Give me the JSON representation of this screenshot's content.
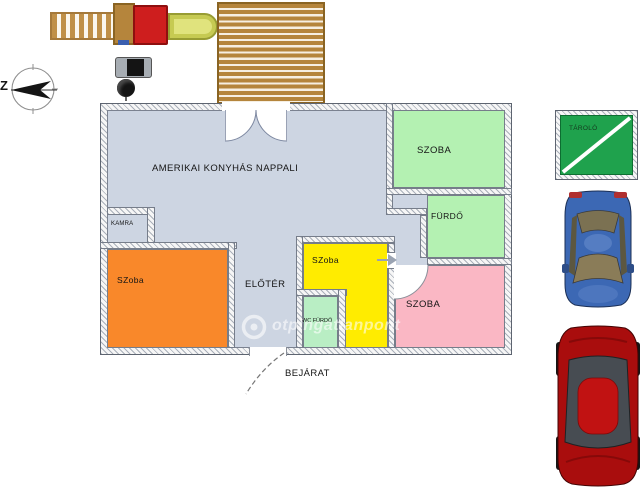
{
  "compass": {
    "label": "Z"
  },
  "floorplan": {
    "rooms": {
      "nappali": "AMERIKAI KONYHÁS NAPPALI",
      "kamra": "KAMRA",
      "szoba_orange": "SZoba",
      "eloter": "ELŐTÉR",
      "szoba_yellow": "SZoba",
      "wc_furdo": "WC FÜRDŐ",
      "szoba_pink": "SZOBA",
      "szoba_green": "SZOBA",
      "furdo": "FÜRDŐ"
    },
    "entrance_label": "BEJÁRAT",
    "colors": {
      "floor": "#cdd5e2",
      "room_green": "#b4f1b2",
      "wc_green": "#b9eec4",
      "room_orange": "#f9882a",
      "room_yellow": "#ffec00",
      "room_pink": "#fab7c4"
    }
  },
  "storage_sign": {
    "label": "TÁROLÓ",
    "color": "#1fa24d"
  },
  "watermark": {
    "text": "otpingatlanpont"
  },
  "objects": {
    "deck": "wooden-deck",
    "ladder": "playground-ladder",
    "tower": "playground-tower",
    "slide": "playground-slide",
    "grill": "grill",
    "car_blue": "blue-car-top-view",
    "car_red": "red-car-top-view"
  }
}
